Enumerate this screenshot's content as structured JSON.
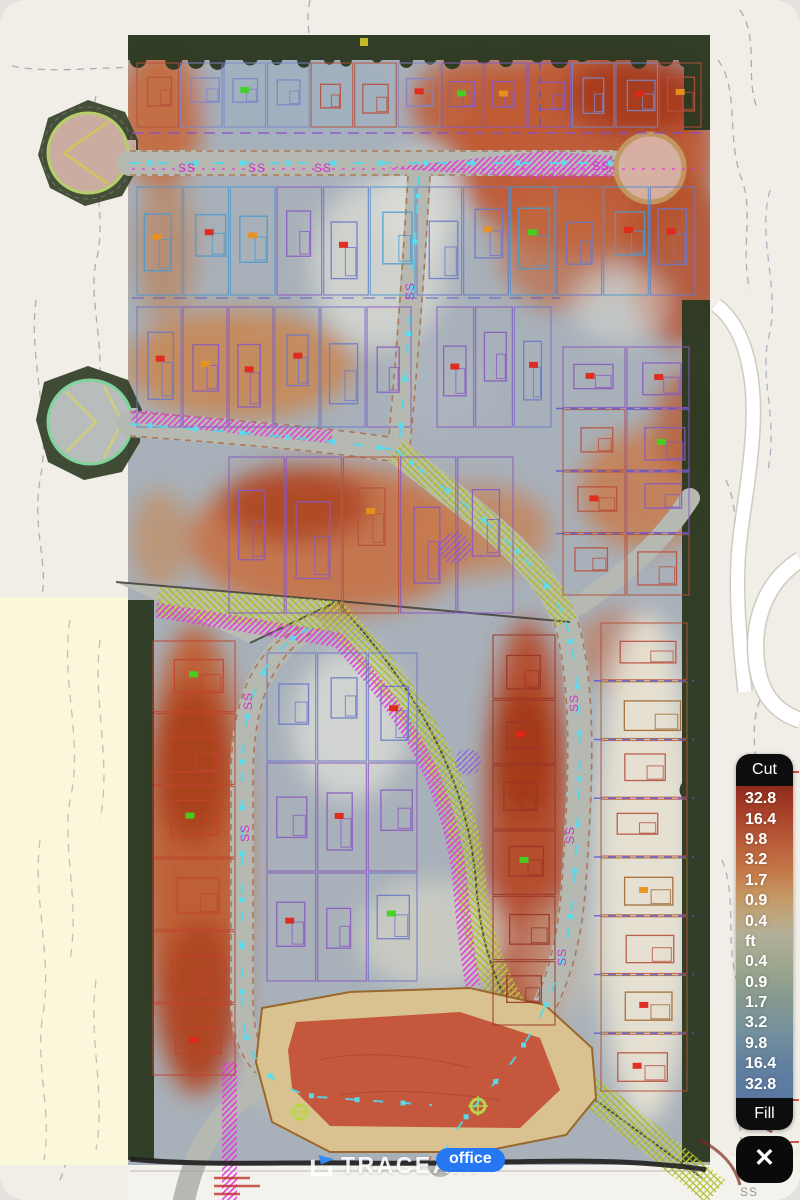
{
  "legend": {
    "cut_label": "Cut",
    "fill_label": "Fill",
    "values": [
      "32.8",
      "16.4",
      "9.8",
      "3.2",
      "1.7",
      "0.9",
      "0.4",
      "ft",
      "0.4",
      "0.9",
      "1.7",
      "3.2",
      "9.8",
      "16.4",
      "32.8"
    ],
    "gradient_stops": [
      "#8f2b1d 0%",
      "#a64029 8%",
      "#b85c39 18%",
      "#c47b4b 28%",
      "#c49a67 36%",
      "#bba883 43%",
      "#b1ae9a 48%",
      "#a5aa91 54%",
      "#96a38d 61%",
      "#859890 69%",
      "#73909d 79%",
      "#63819f 89%",
      "#5a77a0 100%"
    ],
    "pill_bg": "#0d0d0d",
    "text_color": "#ffffff"
  },
  "watermark": {
    "brand": "TRACEAIR",
    "badge": "office",
    "badge_color": "#2677f2"
  },
  "controls": {
    "close_glyph": "✕"
  },
  "map": {
    "ss_label": "SS"
  }
}
